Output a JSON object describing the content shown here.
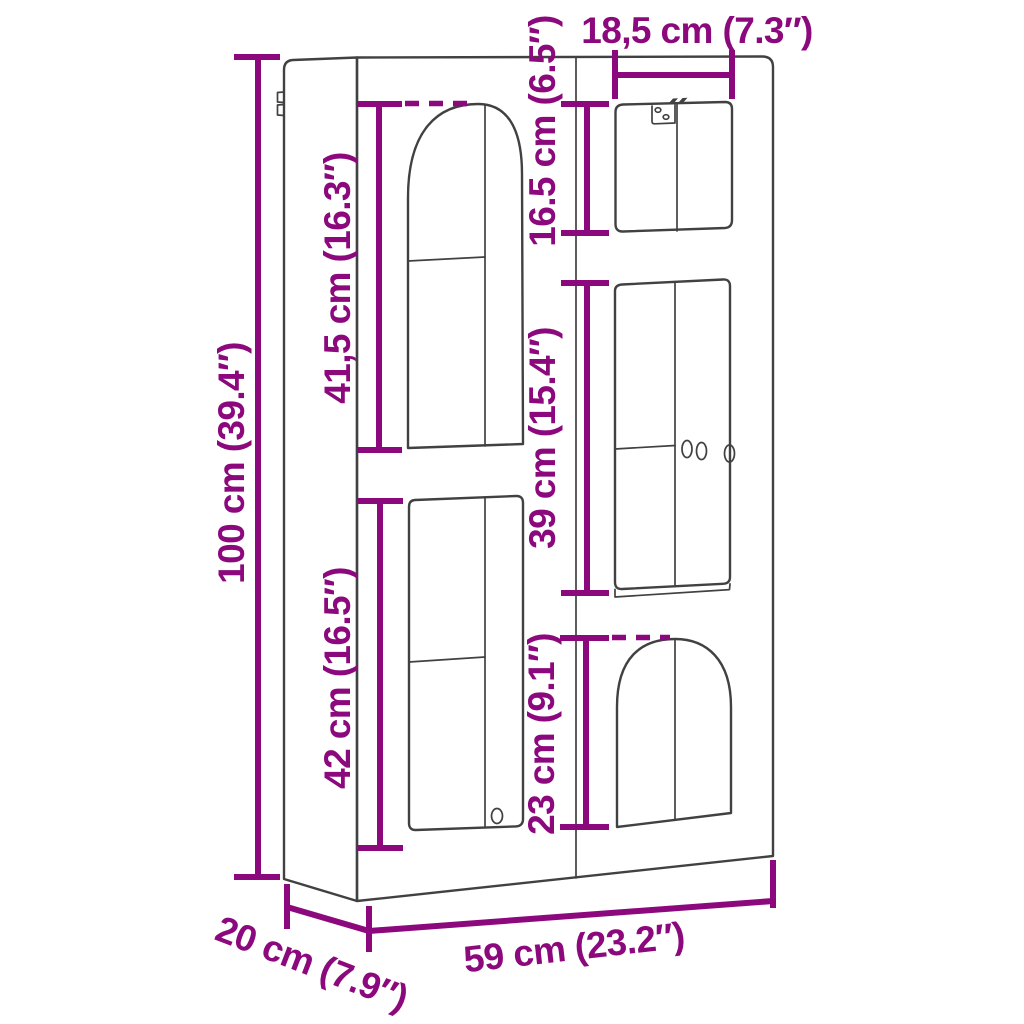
{
  "diagram": {
    "colors": {
      "dimension_accent": "#8C097D",
      "line_art": "#414141",
      "background": "#FFFFFF"
    },
    "dimensions": {
      "total_height": {
        "label": "100 cm (39.4″)"
      },
      "total_width": {
        "label": "59 cm (23.2″)"
      },
      "total_depth": {
        "label": "20 cm (7.9″)"
      },
      "upper_left_door_height": {
        "label": "41,5 cm (16.3″)"
      },
      "lower_left_door_height": {
        "label": "42 cm (16.5″)"
      },
      "top_right_door_width": {
        "label": "18,5 cm (7.3″)"
      },
      "top_right_door_height": {
        "label": "16.5 cm (6.5″)"
      },
      "middle_right_shelf_height": {
        "label": "39 cm (15.4″)"
      },
      "bottom_right_arch_height": {
        "label": "23 cm (9.1″)"
      }
    }
  }
}
